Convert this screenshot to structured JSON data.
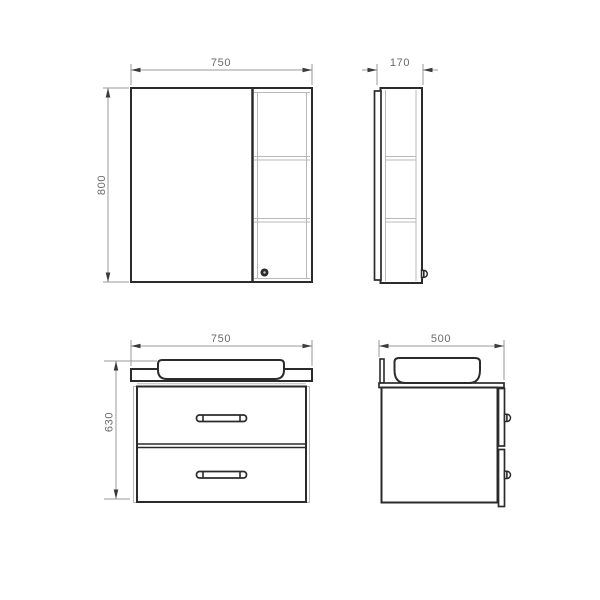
{
  "dimensions": {
    "mirror_cabinet_front": {
      "width": "750",
      "height": "800"
    },
    "mirror_cabinet_side": {
      "depth": "170"
    },
    "vanity_front": {
      "width": "750",
      "height": "630"
    },
    "vanity_side": {
      "depth": "500"
    }
  },
  "colors": {
    "background": "#ffffff",
    "outline": "#2b2b2b",
    "detail_line": "#b8b8b8",
    "dimension_line": "#9a9a9a",
    "dimension_text": "#6a6a6a"
  }
}
